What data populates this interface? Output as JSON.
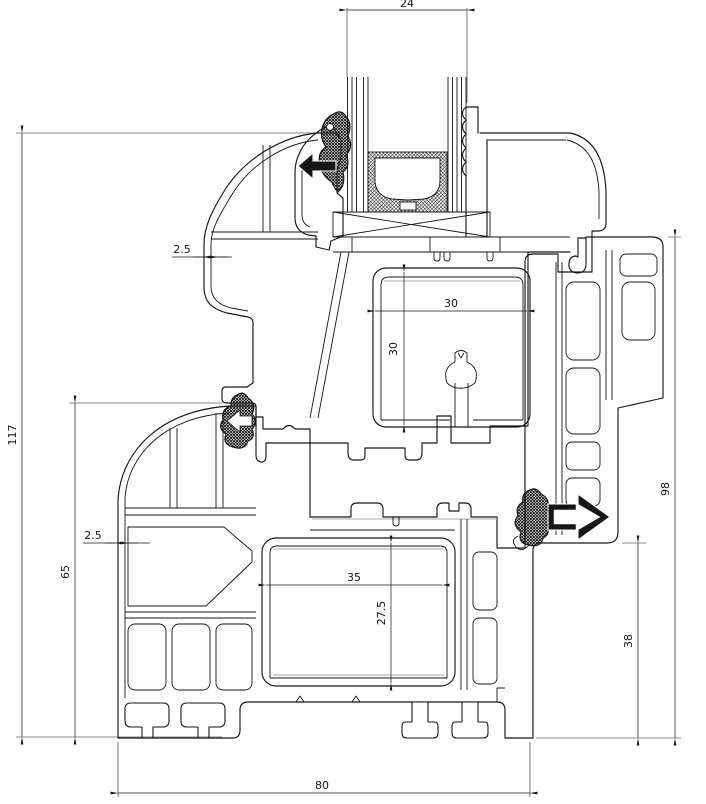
{
  "drawing": {
    "kind": "window-profile-cross-section",
    "background": "#ffffff",
    "line_color": "#161616",
    "shadow_line_color": "#a8a8a8",
    "dimensions": {
      "glazing_unit_width": "24",
      "sash_outer_wall_thickness": "2.5",
      "sash_reinforcement_width": "30",
      "sash_reinforcement_height": "30",
      "total_section_height": "117",
      "frame_height_exterior": "65",
      "frame_outer_wall_thickness": "2.5",
      "frame_reinforcement_width": "35",
      "frame_reinforcement_height": "27.5",
      "frame_height_interior": "98",
      "frame_rebate_to_bottom": "38",
      "frame_depth": "80"
    },
    "icons": {
      "seal_arrow_top": "seal-direction-left",
      "seal_arrow_middle": "seal-direction-left",
      "seal_arrow_right": "seal-direction-right"
    }
  }
}
